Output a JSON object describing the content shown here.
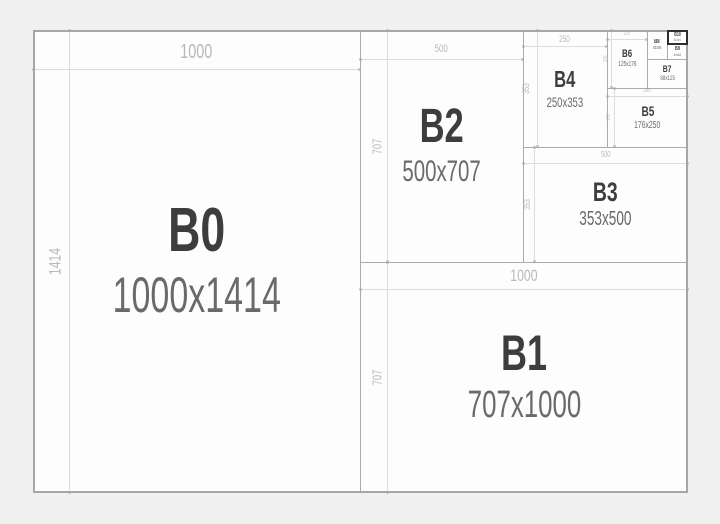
{
  "title": "B-series paper sizes diagram",
  "colors": {
    "background": "#f0f0f1",
    "sheet_fill": "#fdfdfd",
    "divider": "#ababab",
    "dimension_line": "#dcdcdc",
    "dimension_text": "#b9b9b9",
    "name_text": "#3d3d3f",
    "size_text": "#6a6a6a",
    "highlight_border": "#2d2d2d"
  },
  "highlighted_panel": "B10",
  "panels": [
    {
      "id": "B0",
      "name": "B0",
      "size": "1000x1414",
      "width_label": "1000",
      "height_label": "1414"
    },
    {
      "id": "B1",
      "name": "B1",
      "size": "707x1000",
      "width_label": "1000",
      "height_label": "707"
    },
    {
      "id": "B2",
      "name": "B2",
      "size": "500x707",
      "width_label": "500",
      "height_label": "707"
    },
    {
      "id": "B3",
      "name": "B3",
      "size": "353x500",
      "width_label": "500",
      "height_label": "353"
    },
    {
      "id": "B4",
      "name": "B4",
      "size": "250x353",
      "width_label": "250",
      "height_label": "353"
    },
    {
      "id": "B5",
      "name": "B5",
      "size": "176x250",
      "width_label": "250",
      "height_label": "176"
    },
    {
      "id": "B6",
      "name": "B6",
      "size": "125x176",
      "width_label": "125",
      "height_label": "176"
    },
    {
      "id": "B7",
      "name": "B7",
      "size": "88x125"
    },
    {
      "id": "B8",
      "name": "B8",
      "size": "62x88"
    },
    {
      "id": "B9",
      "name": "B9",
      "size": "44x62"
    },
    {
      "id": "B10",
      "name": "B10",
      "size": "31x44"
    }
  ]
}
